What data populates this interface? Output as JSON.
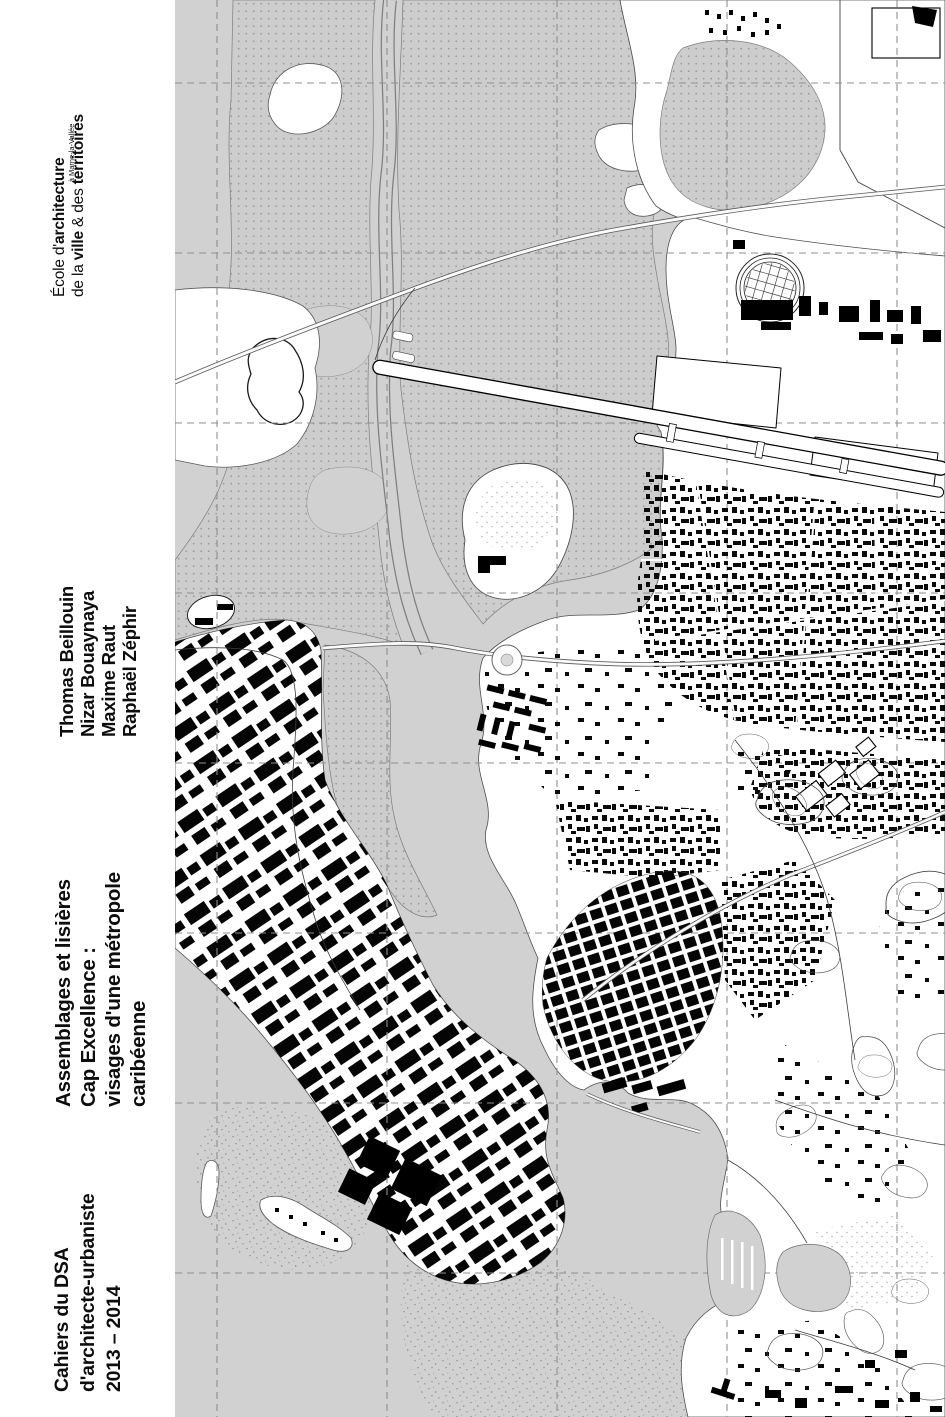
{
  "page": {
    "width_px": 945,
    "height_px": 1417
  },
  "cover": {
    "school": {
      "pre1": "École d'",
      "bold1": "architecture",
      "pre2": "de la ",
      "bold2": "ville",
      "mid2": " & des ",
      "bold3": "territoires",
      "location": "à Marne-la-Vallée"
    },
    "authors": [
      "Thomas Beillouin",
      "Nizar Bouaynaya",
      "Maxime Raut",
      "Raphaël Zéphir"
    ],
    "title_lines": [
      "Assemblages et lisières",
      "Cap Excellence :",
      "visages d'une métropole",
      "caribéenne"
    ],
    "series_lines": [
      "Cahiers du DSA",
      "d'architecte-urbaniste",
      "2013 – 2014"
    ]
  },
  "map": {
    "type": "black-and-white figure-ground city plan, full-bleed",
    "colors": {
      "sea": "#d1d1d1",
      "mangrove_fill": "#cdcdcd",
      "mangrove_dot": "#9c9c9c",
      "land": "#ffffff",
      "building": "#000000",
      "outline": "#4f4f4f",
      "contour": "#4a4a4a",
      "graticule": "#8f8f8f"
    },
    "graticule": {
      "vertical_x_px": [
        217,
        387,
        557,
        727,
        897
      ],
      "horizontal_y_px": [
        83,
        253,
        423,
        593,
        763,
        933,
        1103,
        1273
      ],
      "style": "dashed gray"
    },
    "features": [
      "mangrove-stipple",
      "river-channel",
      "airport-runway",
      "airport-taxiway",
      "circular-stadium-grid",
      "terminal-buildings",
      "dense-city-block-grid",
      "industrial-warehouse-zone",
      "housing-slabs",
      "contour-hills",
      "marina-piers",
      "bays",
      "islets",
      "reef-speckle",
      "roundabout",
      "highways",
      "graticule-grid"
    ]
  }
}
